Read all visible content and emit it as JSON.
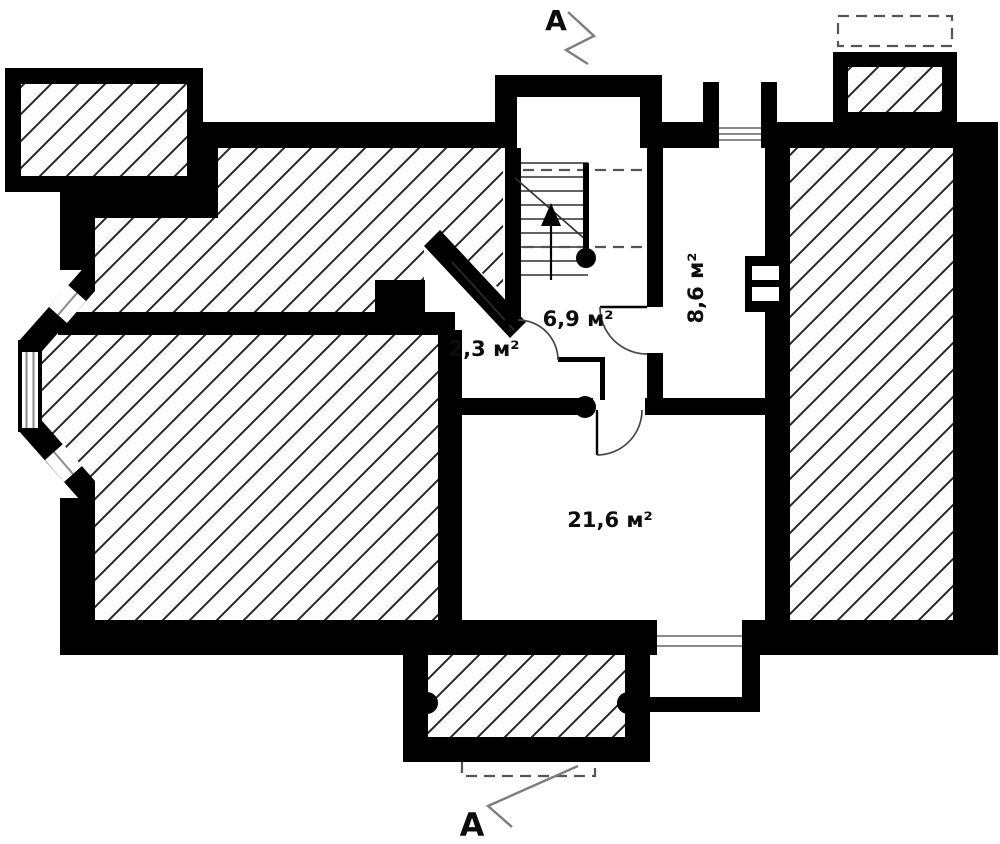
{
  "plan": {
    "rooms": [
      {
        "area_label": "2,3 м²"
      },
      {
        "area_label": "6,9 м²"
      },
      {
        "area_label": "8,6 м²"
      },
      {
        "area_label": "21,6 м²"
      }
    ],
    "section": {
      "top_label": "A",
      "bottom_label": "A"
    }
  },
  "colors": {
    "wall": "#000000",
    "background": "#ffffff",
    "hatch_line": "#262626",
    "window_line": "#8a8a8a",
    "dash_line": "#555555",
    "marker_line": "#7d7d7d",
    "text": "#0d0d0d"
  }
}
